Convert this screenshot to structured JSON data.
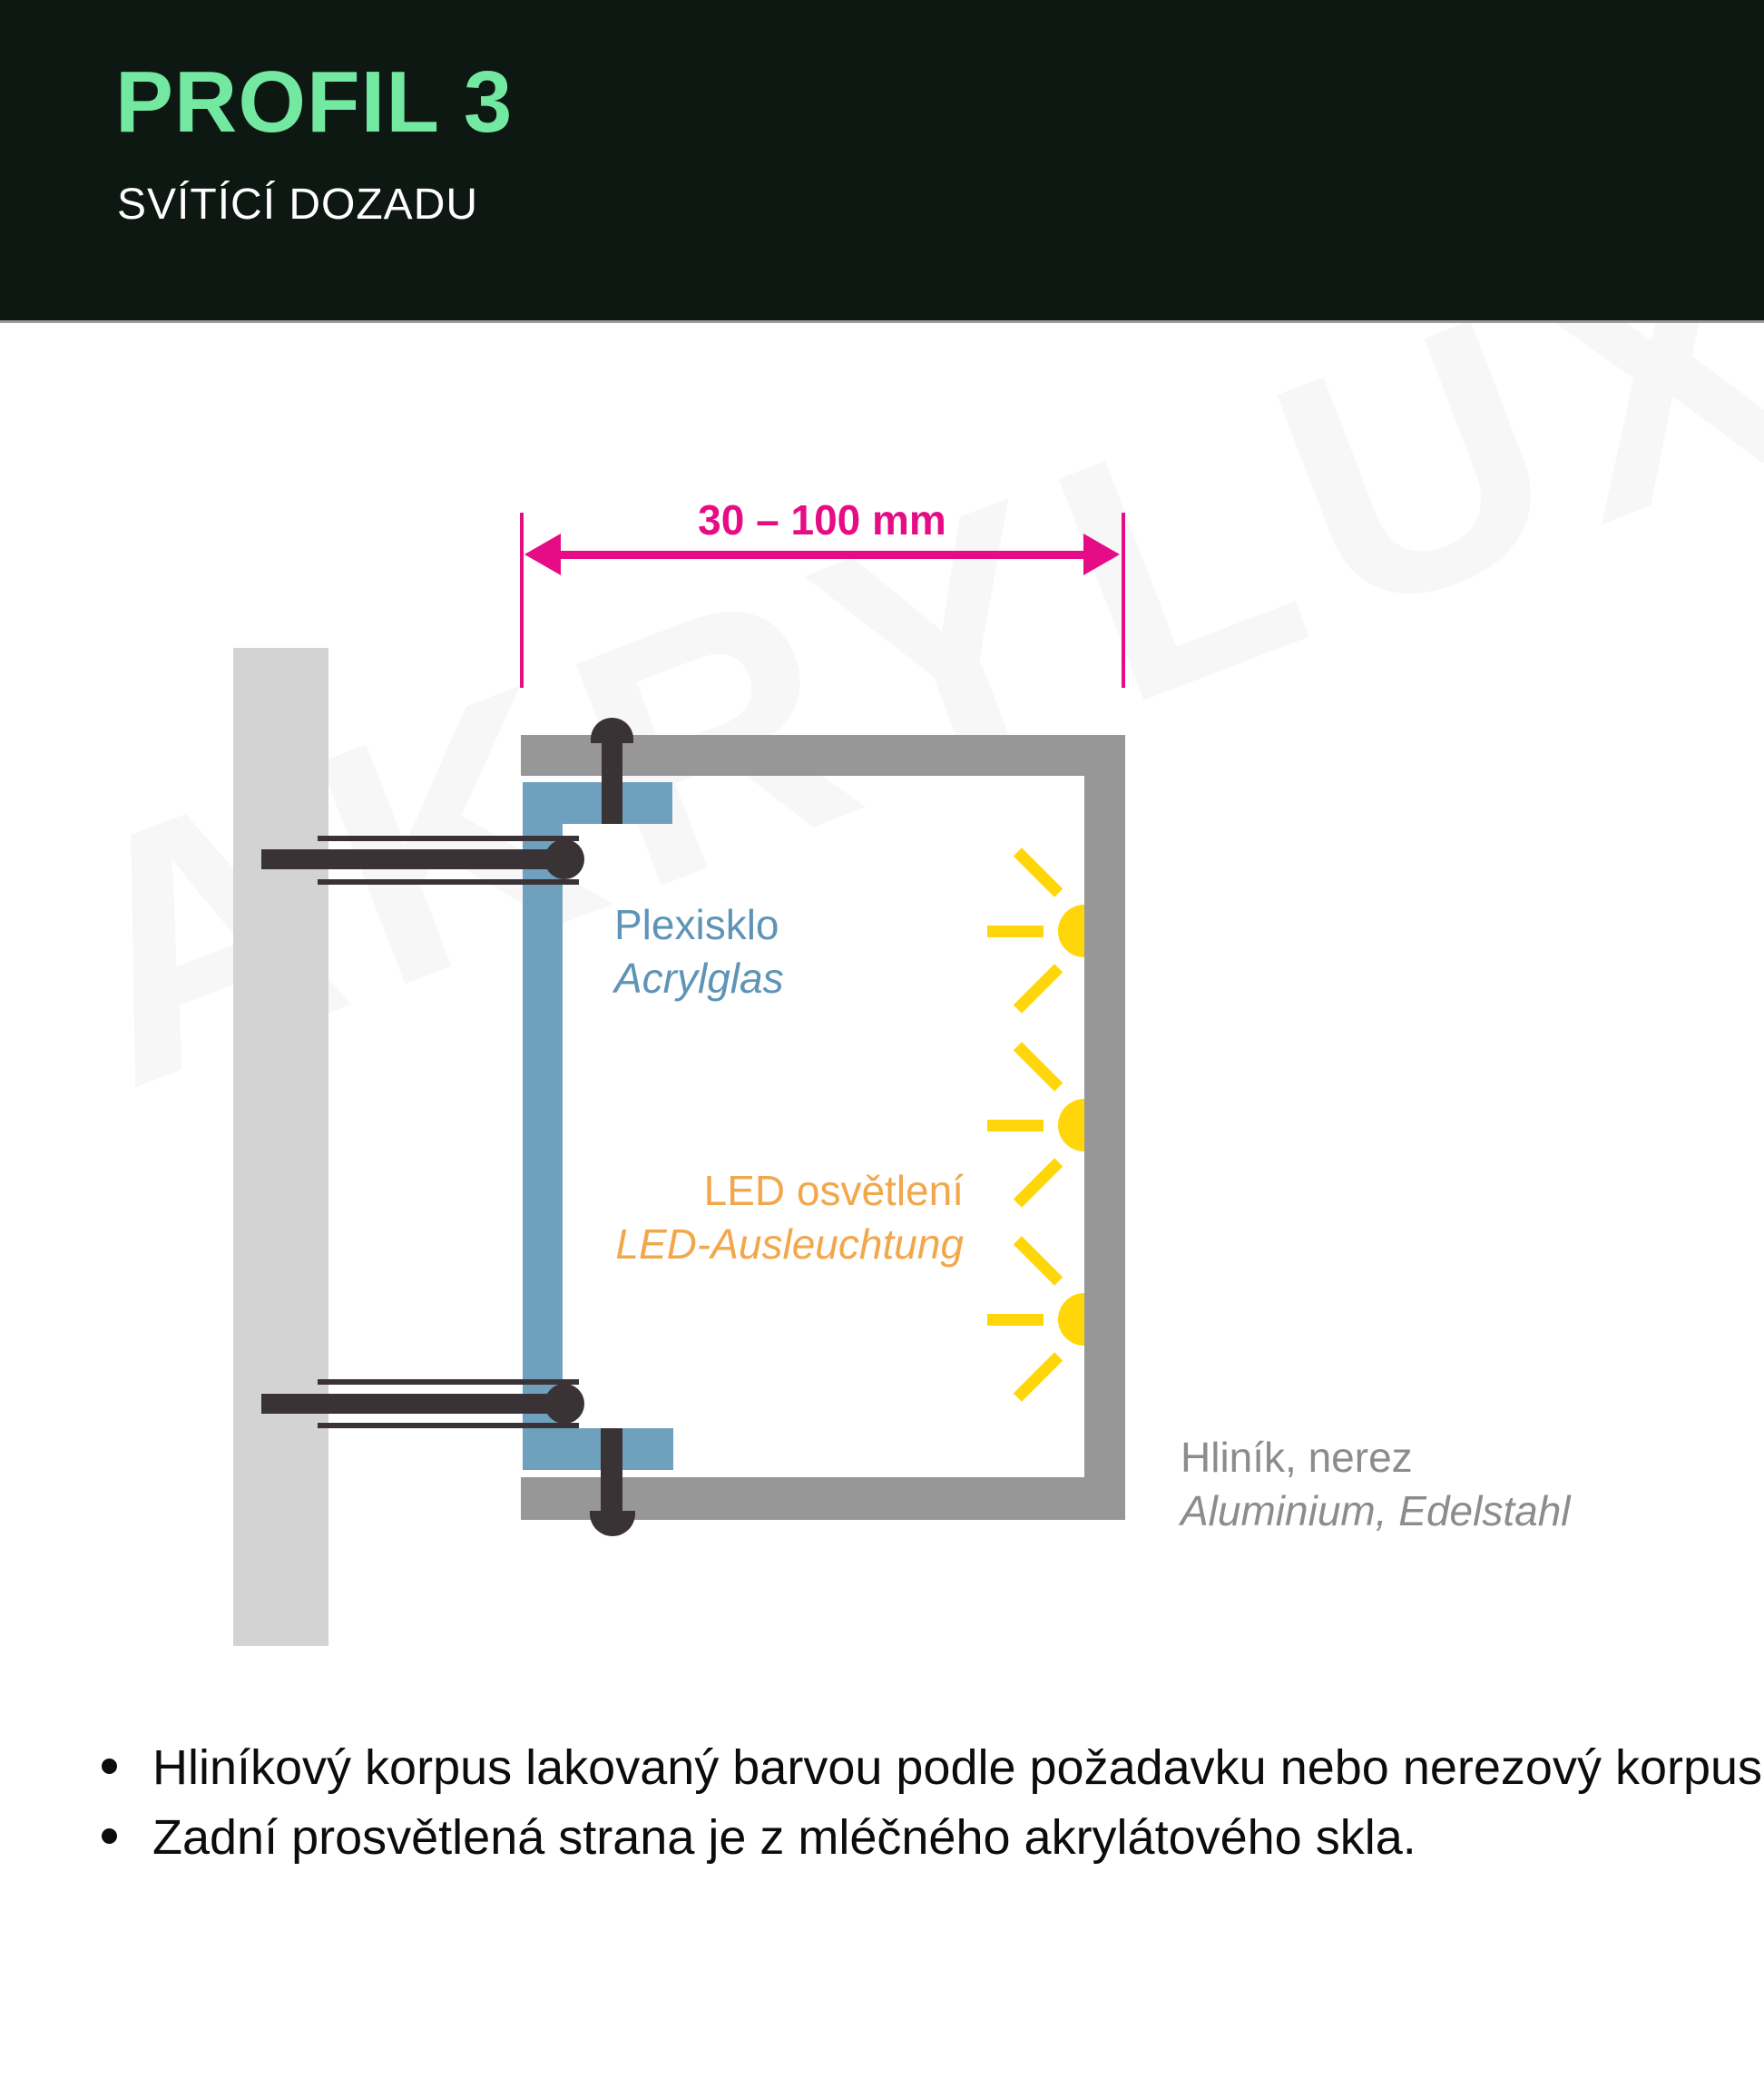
{
  "header": {
    "title": "PROFIL 3",
    "subtitle": "SVÍTÍCÍ DOZADU"
  },
  "dimension": {
    "label": "30 – 100 mm"
  },
  "labels": {
    "acrylic": {
      "cz": "Plexisklo",
      "de": "Acrylglas"
    },
    "led": {
      "cz": "LED osvětlení",
      "de": "LED-Ausleuchtung"
    },
    "body": {
      "cz": "Hliník, nerez",
      "de": "Aluminium, Edelstahl"
    }
  },
  "bullets": [
    "Hliníkový korpus lakovaný barvou podle požadavku nebo nerezový korpus.",
    "Zadní prosvětlená strana je z mléčného akrylátového skla."
  ],
  "watermark": "AKRYLUX",
  "colors": {
    "header_bg": "#0e1813",
    "title_green": "#72e8a0",
    "dimension_pink": "#e60c86",
    "profile_gray": "#979797",
    "wall_gray": "#d4d3d3",
    "acrylic_blue": "#6fa1bf",
    "acrylic_text_blue": "#5e94b6",
    "led_yellow": "#ffd60a",
    "led_text_orange": "#f2a74b",
    "body_text_gray": "#8c8c8c",
    "fastener_dark": "#3a3335"
  }
}
